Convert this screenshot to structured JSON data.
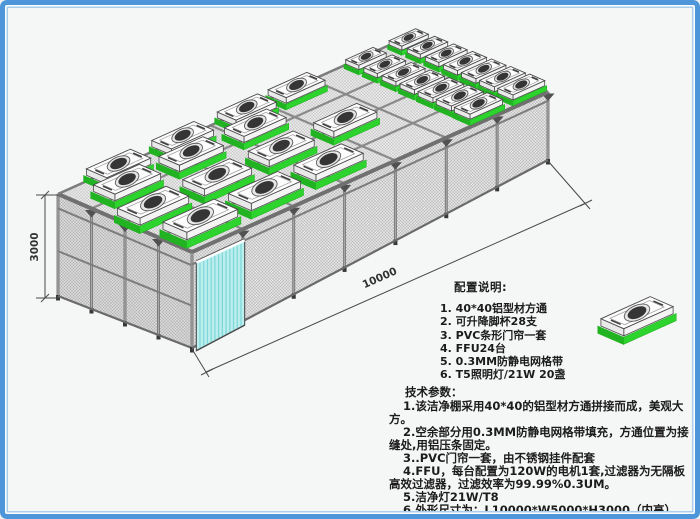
{
  "frame": {
    "background": "#f5f6f6",
    "border_color": "#4d96da",
    "inner_line_color": "#a9cdee"
  },
  "diagram": {
    "dimensions": {
      "height_label": "3000",
      "length_label": "10000"
    },
    "colors": {
      "accent_green": "#2dd42d",
      "accent_green_dark": "#21b321",
      "door_cyan": "#bdeeee",
      "door_stripe": "#7fd9da",
      "frame_gray": "#7d7d7d",
      "beam_dark": "#5c5c5c",
      "mesh_base": "#e1e1e1",
      "mesh_line": "#b2b2b2",
      "fan_dark": "#353535",
      "dim_line": "#4a4a4a"
    },
    "ffu_units": {
      "scattered": [
        {
          "u": 0.08,
          "v": 0.15
        },
        {
          "u": 0.26,
          "v": 0.15
        },
        {
          "u": 0.44,
          "v": 0.15
        },
        {
          "u": 0.06,
          "v": 0.45
        },
        {
          "u": 0.24,
          "v": 0.45
        },
        {
          "u": 0.42,
          "v": 0.45
        },
        {
          "u": 0.6,
          "v": 0.45
        },
        {
          "u": 0.1,
          "v": 0.75
        },
        {
          "u": 0.28,
          "v": 0.75
        },
        {
          "u": 0.46,
          "v": 0.75
        },
        {
          "u": 0.14,
          "v": 0.92
        },
        {
          "u": 0.32,
          "v": 0.92
        },
        {
          "u": 0.5,
          "v": 0.92
        },
        {
          "u": 0.64,
          "v": 0.92
        }
      ],
      "dense_back_rows": [
        {
          "u": 0.835,
          "v": 0.08
        },
        {
          "u": 0.835,
          "v": 0.22
        },
        {
          "u": 0.835,
          "v": 0.36
        },
        {
          "u": 0.835,
          "v": 0.5
        },
        {
          "u": 0.835,
          "v": 0.64
        },
        {
          "u": 0.835,
          "v": 0.78
        },
        {
          "u": 0.835,
          "v": 0.92
        },
        {
          "u": 0.955,
          "v": 0.08
        },
        {
          "u": 0.955,
          "v": 0.22
        },
        {
          "u": 0.955,
          "v": 0.36
        },
        {
          "u": 0.955,
          "v": 0.5
        },
        {
          "u": 0.955,
          "v": 0.64
        },
        {
          "u": 0.955,
          "v": 0.78
        },
        {
          "u": 0.955,
          "v": 0.92
        }
      ]
    }
  },
  "config_notes": {
    "title": "配置说明:",
    "items": [
      "1. 40*40铝型材方通",
      "2. 可升降脚杯28支",
      "3. PVC条形门帘一套",
      "4. FFU24台",
      "5. 0.3MM防静电网格带",
      "6. T5照明灯/21W 20盏"
    ]
  },
  "tech_params": {
    "title": "技术参数：",
    "items": [
      "1.该洁净棚采用40*40的铝型材方通拼接而成，美观大方。",
      "2.空余部分用0.3MM防静电网格带填充，方通位置为接缝处,用铝压条固定。",
      "3..PVC门帘一套，由不锈钢挂件配套",
      "4.FFU，每台配置为120W的电机1套,过滤器为无隔板高效过滤器，过滤效率为99.99%0.3UM。",
      "5.洁净灯21W/T8",
      "6.外形尺寸为：L10000*W5000*H3000（内高）"
    ]
  }
}
